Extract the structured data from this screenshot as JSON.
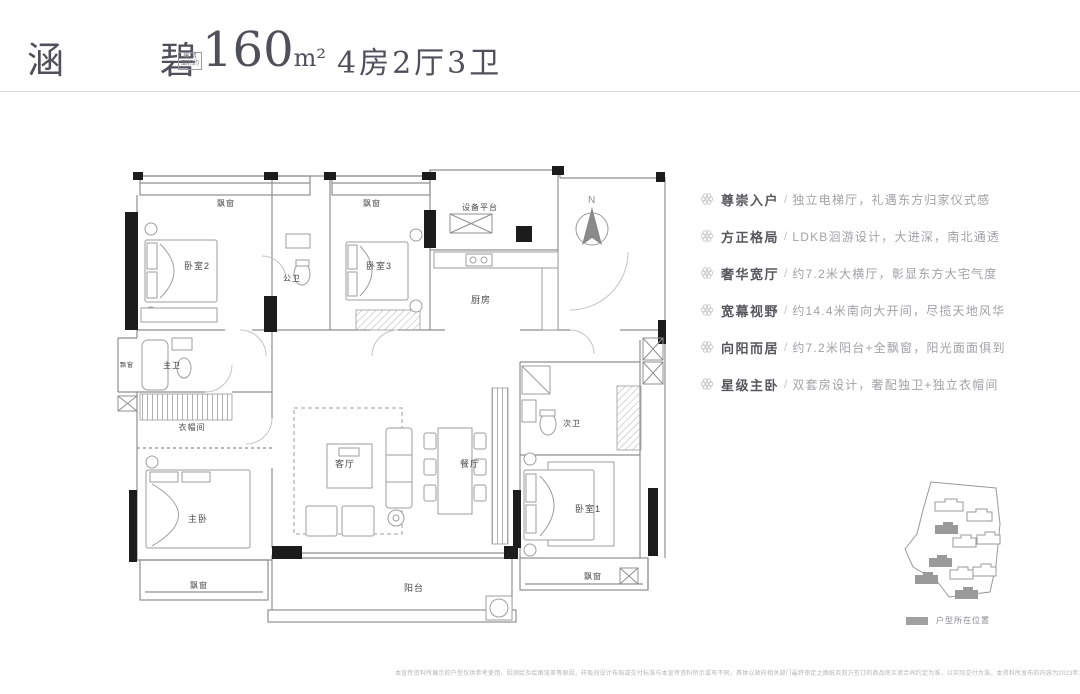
{
  "header": {
    "title": "涵 碧",
    "area_note_top": "建 筑",
    "area_note_bottom": "面积约",
    "area_value": "160",
    "area_unit": "m²",
    "layout_text": "4房2厅3卫"
  },
  "compass": {
    "label": "N"
  },
  "floorplan": {
    "rooms": [
      {
        "id": "bay-window-top-left",
        "label": "飘窗",
        "x": 226,
        "y": 206,
        "size": 8
      },
      {
        "id": "bedroom-2",
        "label": "卧室2",
        "x": 197,
        "y": 269,
        "size": 9
      },
      {
        "id": "guest-bath",
        "label": "公卫",
        "x": 292,
        "y": 281,
        "size": 8
      },
      {
        "id": "bay-window-top-mid",
        "label": "飘窗",
        "x": 372,
        "y": 206,
        "size": 8
      },
      {
        "id": "bedroom-3",
        "label": "卧室3",
        "x": 379,
        "y": 269,
        "size": 9
      },
      {
        "id": "equipment-platform",
        "label": "设备平台",
        "x": 480,
        "y": 210,
        "size": 8
      },
      {
        "id": "kitchen",
        "label": "厨房",
        "x": 481,
        "y": 303,
        "size": 9
      },
      {
        "id": "bay-window-left",
        "label": "飘窗",
        "x": 127,
        "y": 367,
        "size": 6
      },
      {
        "id": "master-bath",
        "label": "主卫",
        "x": 172,
        "y": 368,
        "size": 8
      },
      {
        "id": "walk-in-closet",
        "label": "衣帽间",
        "x": 192,
        "y": 430,
        "size": 8
      },
      {
        "id": "master-bedroom",
        "label": "主卧",
        "x": 198,
        "y": 522,
        "size": 9
      },
      {
        "id": "living-room",
        "label": "客厅",
        "x": 345,
        "y": 467,
        "size": 9
      },
      {
        "id": "dining-room",
        "label": "餐厅",
        "x": 470,
        "y": 467,
        "size": 9
      },
      {
        "id": "second-bath",
        "label": "次卫",
        "x": 572,
        "y": 426,
        "size": 8
      },
      {
        "id": "bedroom-1",
        "label": "卧室1",
        "x": 588,
        "y": 512,
        "size": 9
      },
      {
        "id": "bay-window-bottom-left",
        "label": "飘窗",
        "x": 199,
        "y": 588,
        "size": 8
      },
      {
        "id": "balcony",
        "label": "阳台",
        "x": 414,
        "y": 591,
        "size": 9
      },
      {
        "id": "bay-window-bottom-right",
        "label": "飘窗",
        "x": 593,
        "y": 579,
        "size": 8
      }
    ]
  },
  "features": {
    "separator": "/",
    "items": [
      {
        "title": "尊崇入户",
        "desc": "独立电梯厅，礼遇东方归家仪式感"
      },
      {
        "title": "方正格局",
        "desc": "LDKB洄游设计，大进深，南北通透"
      },
      {
        "title": "奢华宽厅",
        "desc": "约7.2米大横厅，彰显东方大宅气度"
      },
      {
        "title": "宽幕视野",
        "desc": "约14.4米南向大开间，尽揽天地风华"
      },
      {
        "title": "向阳而居",
        "desc": "约7.2米阳台+全飘窗，阳光面面俱到"
      },
      {
        "title": "星级主卧",
        "desc": "双套房设计，奢配独卫+独立衣帽间"
      }
    ]
  },
  "siteplan": {
    "legend_label": "户型所在位置"
  },
  "disclaimer": "本宣传资料所展示的户型仅供参考使用，因测绘及绘图误差等原因，样板间设计布局或交付标准与本宣传资料所示或有不同，具体以政府相关部门最终审定之图纸及双方签订的商品房买卖合同约定为准，以实际交付为准。本资料所发布的内容为2023年12月8日前的信息，请谨慎参阅，谨请垂询最新资料。"
}
